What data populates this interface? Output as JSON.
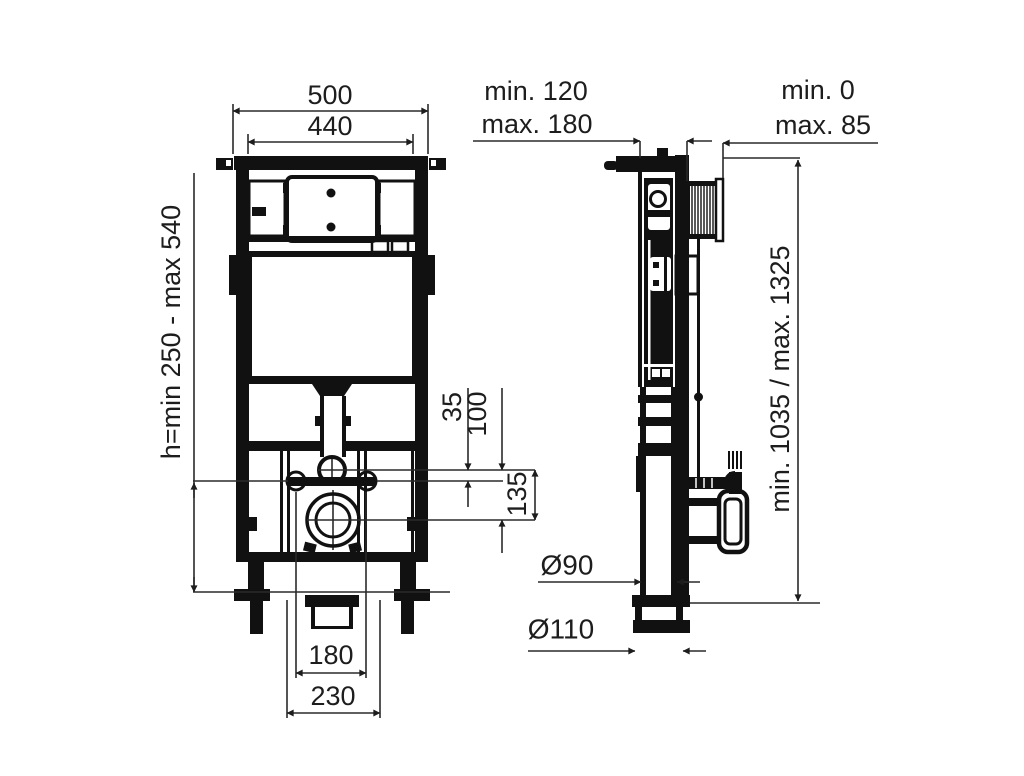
{
  "drawing": {
    "type": "installation-frame-technical-drawing",
    "views": [
      "front-view",
      "side-view"
    ]
  },
  "dims": {
    "width_outer": "500",
    "width_inner": "440",
    "depth_min": "min. 120",
    "depth_max": "max. 180",
    "tile_min": "min. 0",
    "tile_max": "max. 85",
    "bolt_height": "h=min 250 - max 540",
    "flush_bolt_gap": "35",
    "bolt_drain_gap": "100",
    "flush_drain_gap": "135",
    "frame_height": "min. 1035 / max. 1325",
    "drain_dia": "Ø90",
    "outlet_dia": "Ø110",
    "bolt_spacing": "180",
    "outlet_spacing": "230"
  }
}
